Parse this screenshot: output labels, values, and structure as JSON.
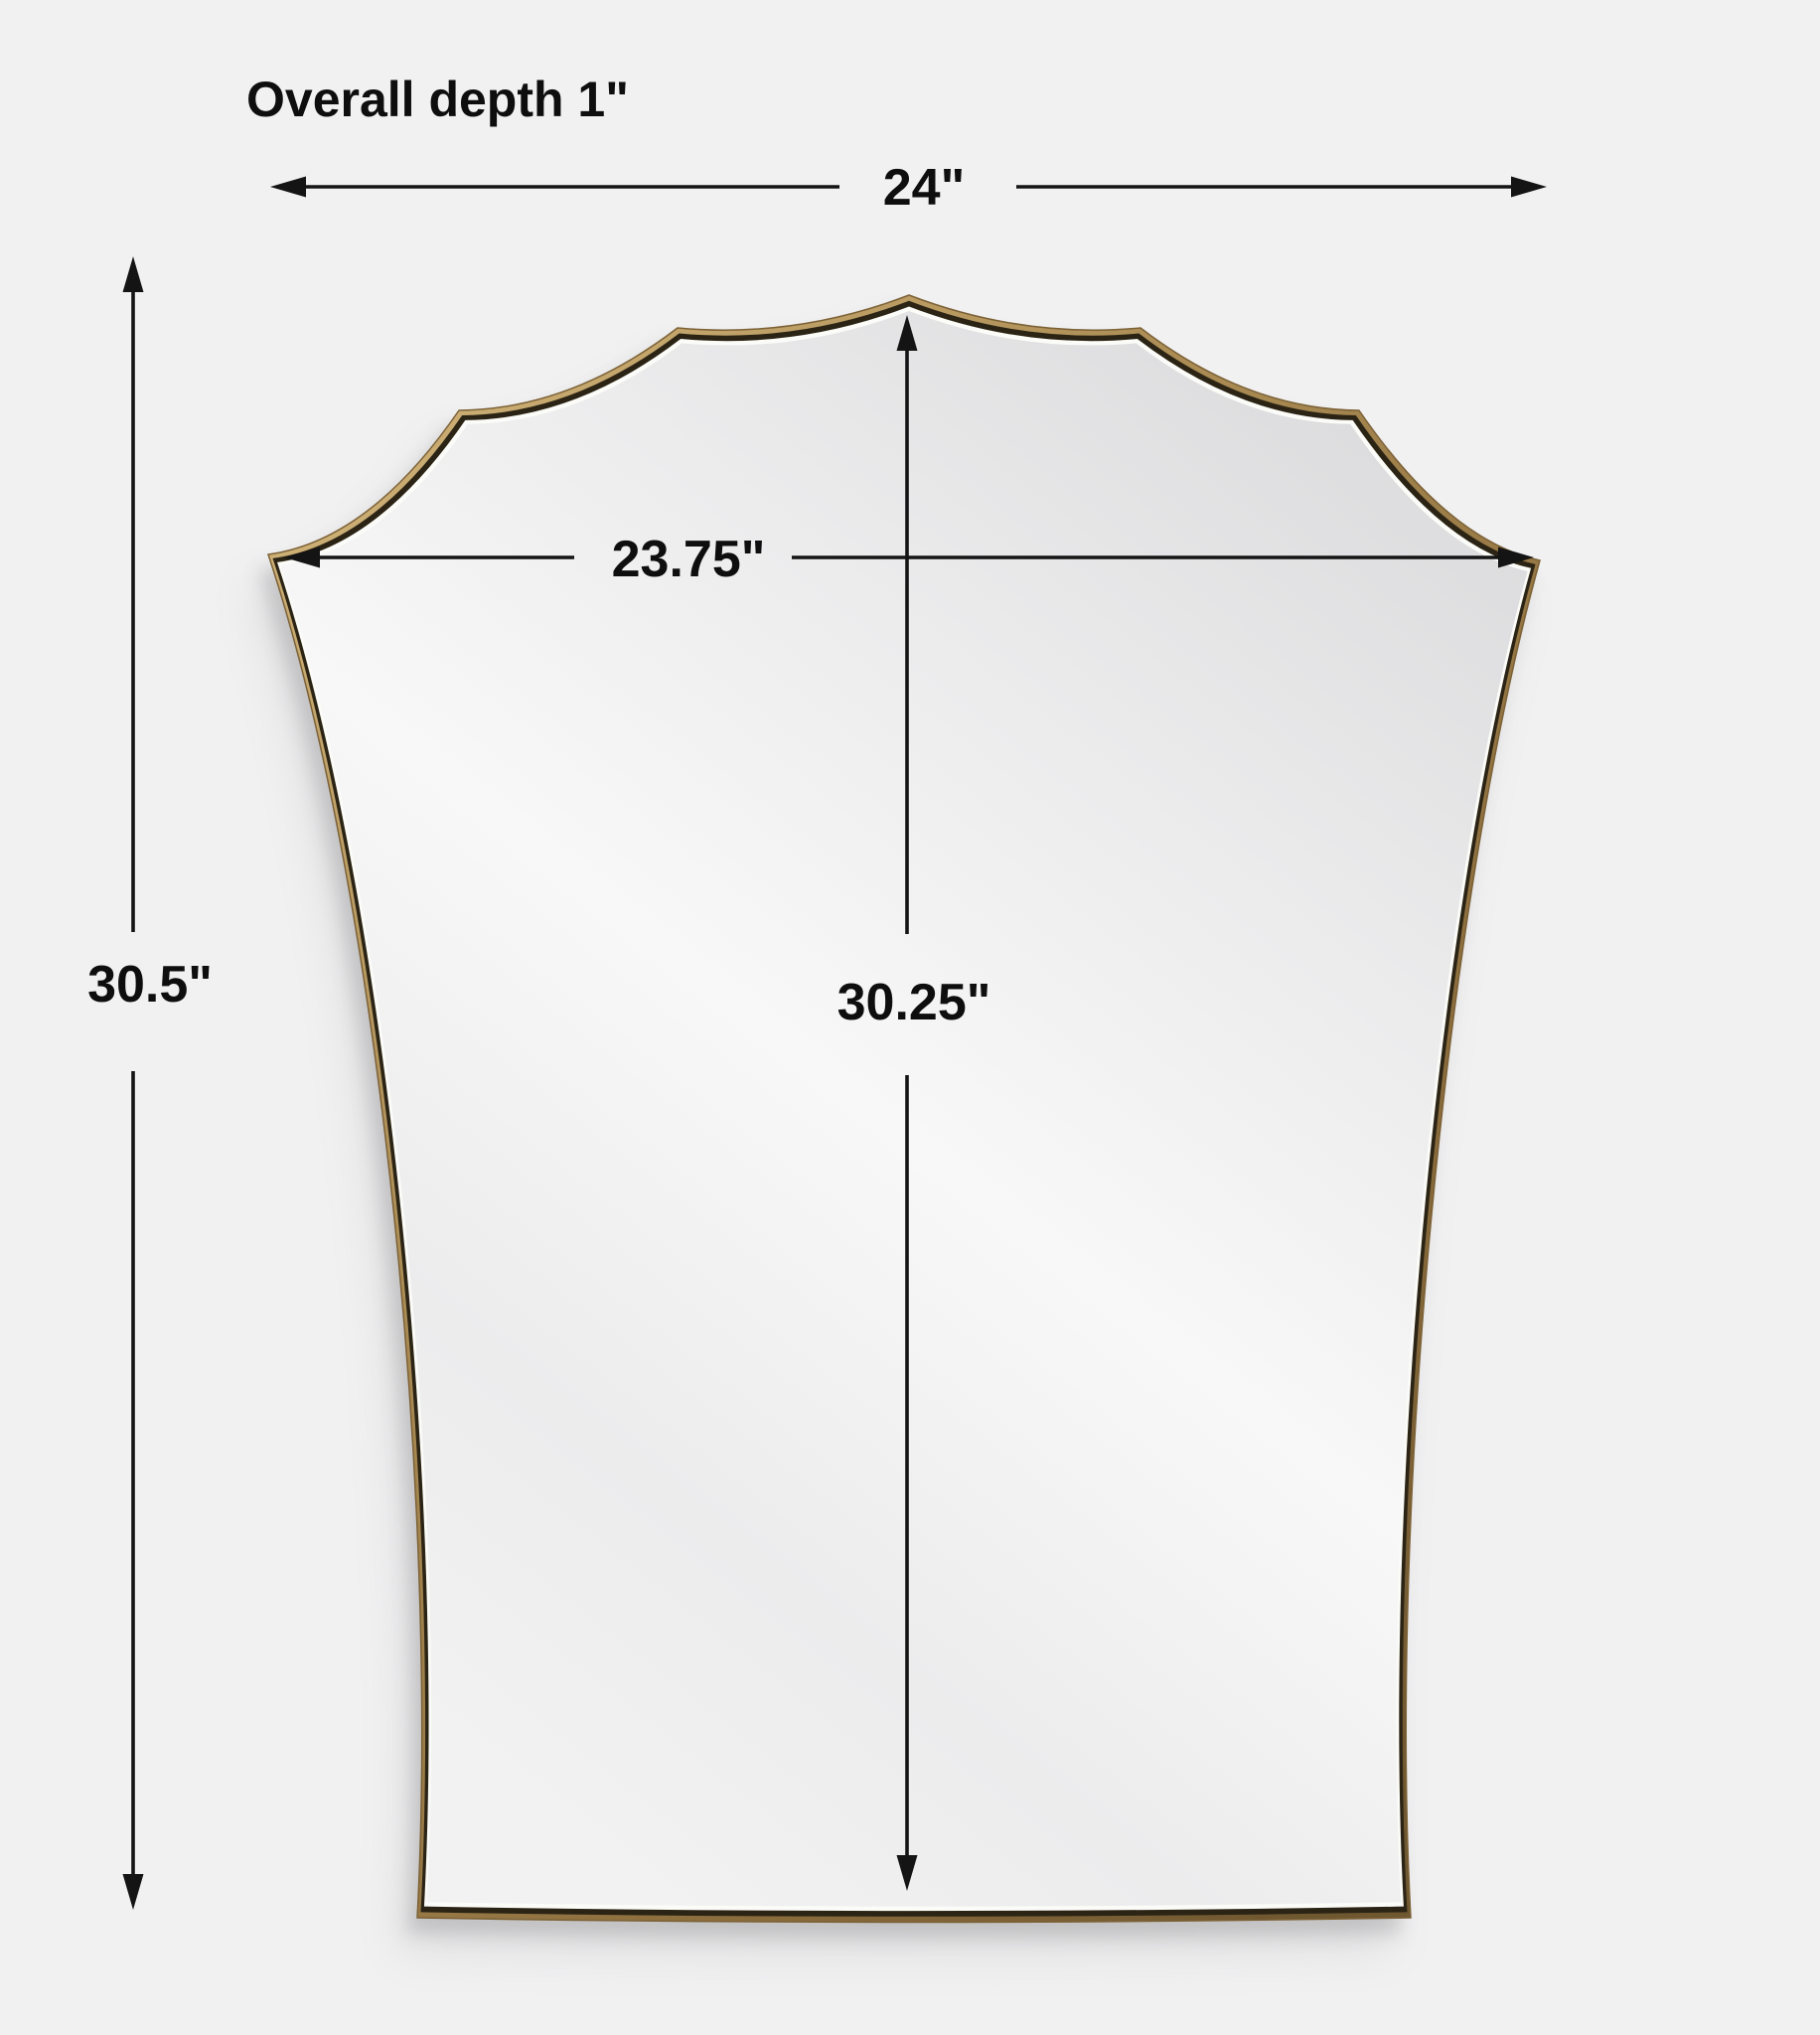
{
  "page": {
    "background_color": "#f1f1f2",
    "description": "Product dimension diagram of a scalloped shield-shaped wall mirror with a thin brass frame"
  },
  "figure": {
    "product": "scalloped shield wall mirror",
    "frame_outer_color": "#a8894f",
    "frame_inner_dark_color": "#2b2415",
    "frame_highlight_color": "#fbfbf8",
    "glass_color": "#ededee",
    "dimension_line_color": "#141414"
  },
  "dimensions": {
    "overall_depth_label": "Overall depth 1\"",
    "overall_width": "24\"",
    "mirror_width": "23.75\"",
    "overall_height": "30.5\"",
    "mirror_height": "30.25\""
  }
}
